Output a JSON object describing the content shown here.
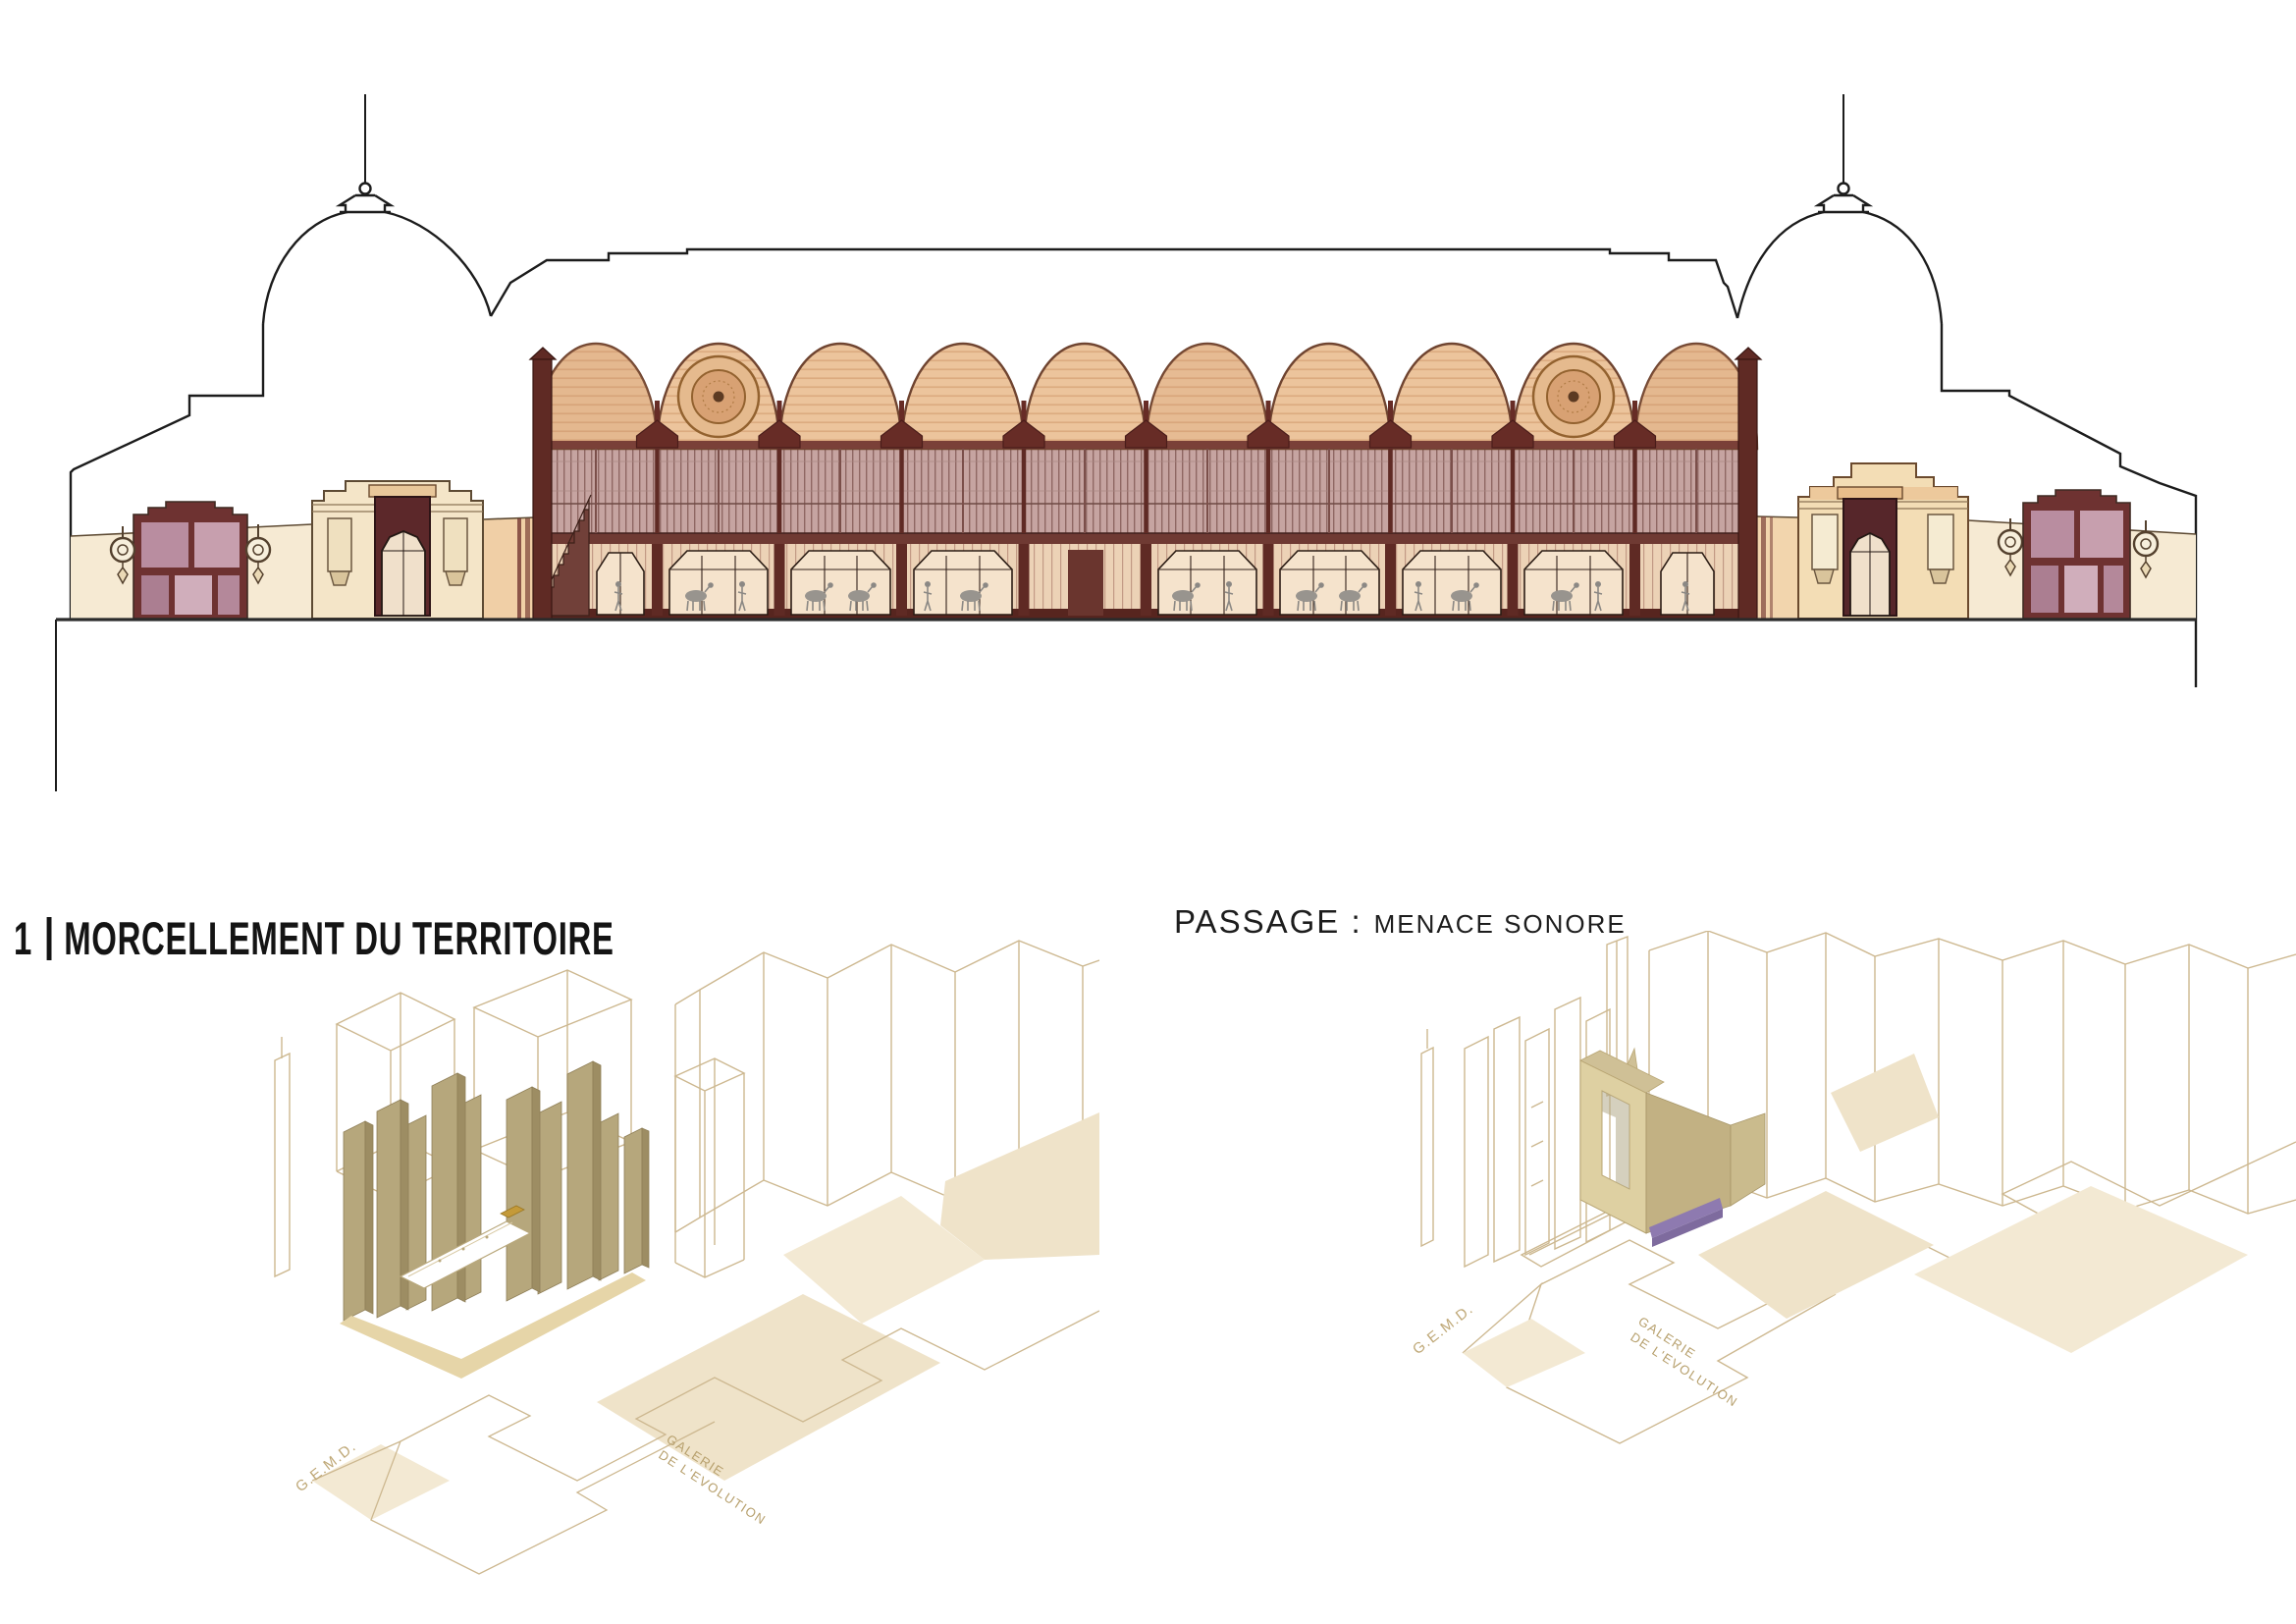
{
  "titles": {
    "diagram1": {
      "number": "1",
      "separator": "|",
      "label": "MORCELLEMENT DU TERRITOIRE"
    },
    "diagram2": {
      "primary": "PASSAGE :",
      "secondary": "MENACE SONORE"
    }
  },
  "axon_left": {
    "label_gemd": "G.E.M.D.",
    "label_galerie_line1": "GALERIE",
    "label_galerie_line2": "DE L'EVOLUTION"
  },
  "axon_right": {
    "label_gemd": "G.E.M.D.",
    "label_galerie_line1": "GALERIE",
    "label_galerie_line2": "DE L'EVOLUTION"
  },
  "palette": {
    "outline_black": "#1c1c1c",
    "vault_peach": "#ecc49c",
    "vault_stripe": "#dcab80",
    "iron_dark_red": "#672c26",
    "cornice_red": "#7a4038",
    "upper_glazing": "#c6a4a1",
    "lower_glazing": "#ecd2b6",
    "plinth": "#57251f",
    "wing_cream": "#f6ead3",
    "portal_cream": "#f4e5c8",
    "portal_peach": "#ecc699",
    "window_mauve": "#b98da0",
    "window_frame": "#6e3231",
    "axon_wireframe_tan": "#cdb890",
    "axon_slab_khaki": "#b6a77c",
    "axon_floor_beige": "#f0e5cd",
    "axon_purple": "#8e7ab0",
    "axon_gold": "#c49a39",
    "label_tan": "#bfa877"
  }
}
